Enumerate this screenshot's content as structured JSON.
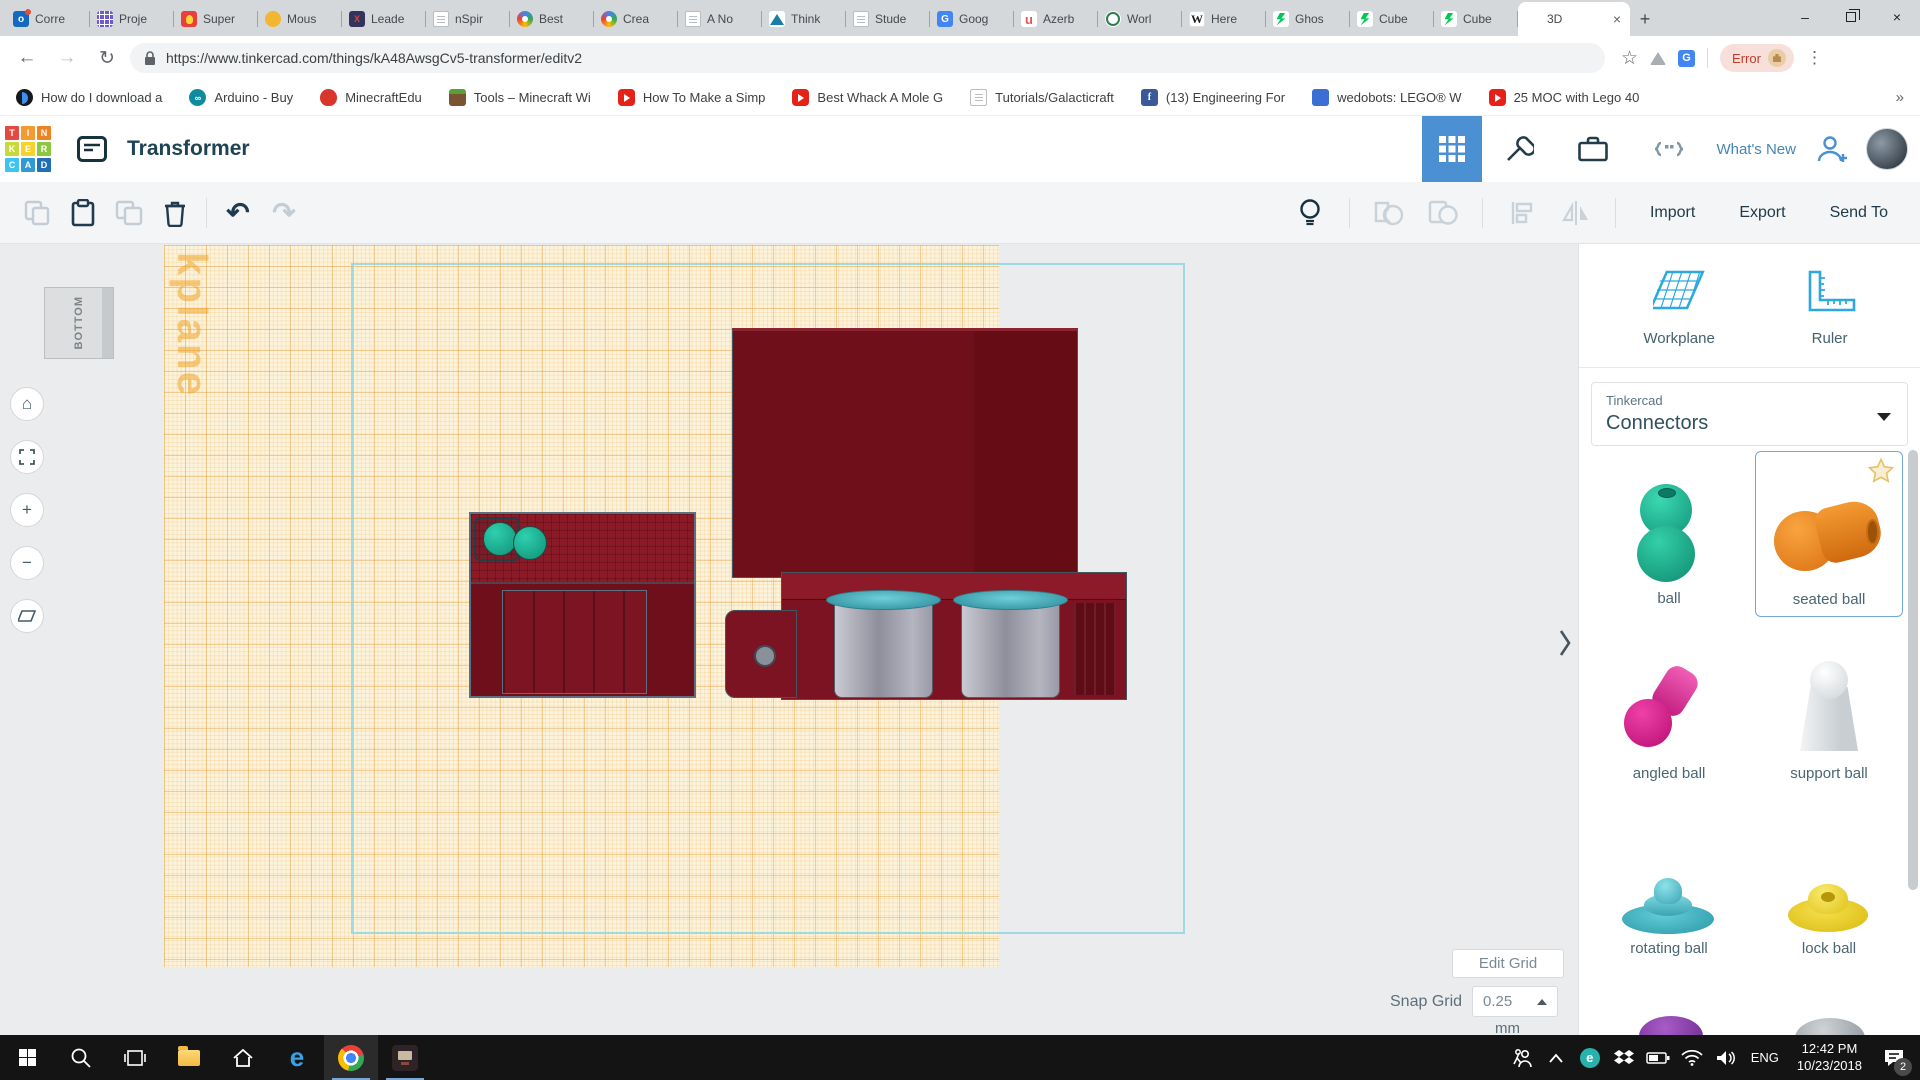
{
  "icons": {
    "back": "←",
    "forward": "→",
    "reload": "↻",
    "star": "☆",
    "menu_dots": "⋮",
    "new_tab": "+",
    "close": "×",
    "overflow": "»",
    "home": "⌂",
    "zoom_in": "+",
    "zoom_out": "−",
    "undo": "↶",
    "redo": "↷",
    "minimize": "–",
    "eset_letter": "e",
    "arduino_glyph": "∞",
    "edx_glyph": "X",
    "udemy_glyph": "u",
    "wiki_glyph": "W",
    "fb_glyph": "f",
    "translate_glyph": "G",
    "outlook_glyph": "o"
  },
  "browser": {
    "tabs": [
      {
        "label": "Corre",
        "icon": "outlook"
      },
      {
        "label": "Proje",
        "icon": "grid-purple"
      },
      {
        "label": "Super",
        "icon": "bulb-red"
      },
      {
        "label": "Mous",
        "icon": "mouse-yellow"
      },
      {
        "label": "Leade",
        "icon": "edx"
      },
      {
        "label": "nSpir",
        "icon": "doc"
      },
      {
        "label": "Best",
        "icon": "palette"
      },
      {
        "label": "Crea",
        "icon": "palette"
      },
      {
        "label": "A No",
        "icon": "doc"
      },
      {
        "label": "Think",
        "icon": "autodesk"
      },
      {
        "label": "Stude",
        "icon": "doc"
      },
      {
        "label": "Goog",
        "icon": "translate"
      },
      {
        "label": "Azerb",
        "icon": "udemy"
      },
      {
        "label": "Worl",
        "icon": "wes"
      },
      {
        "label": "Here",
        "icon": "wikipedia"
      },
      {
        "label": "Ghos",
        "icon": "deviantart"
      },
      {
        "label": "Cube",
        "icon": "deviantart"
      },
      {
        "label": "Cube",
        "icon": "deviantart"
      }
    ],
    "active_tab": {
      "label": "3D",
      "icon": "tinkercad"
    },
    "url": "https://www.tinkercad.com/things/kA48AwsgCv5-transformer/editv2",
    "error_chip": "Error"
  },
  "bookmarks": [
    {
      "label": "How do I download a",
      "icon": "circle-blue"
    },
    {
      "label": "Arduino - Buy",
      "icon": "arduino"
    },
    {
      "label": "MinecraftEdu",
      "icon": "apple-red"
    },
    {
      "label": "Tools – Minecraft Wi",
      "icon": "grass-block"
    },
    {
      "label": "How To Make a Simp",
      "icon": "youtube"
    },
    {
      "label": "Best Whack A Mole G",
      "icon": "youtube"
    },
    {
      "label": "Tutorials/Galacticraft",
      "icon": "doc"
    },
    {
      "label": "(13) Engineering For",
      "icon": "facebook"
    },
    {
      "label": "wedobots: LEGO® W",
      "icon": "robot"
    },
    {
      "label": "25 MOC with Lego 40",
      "icon": "youtube"
    }
  ],
  "header": {
    "title": "Transformer",
    "whats_new": "What's New",
    "logo_letters": [
      "T",
      "I",
      "N",
      "K",
      "E",
      "R",
      "C",
      "A",
      "D"
    ],
    "accent_color": "#4a90d2"
  },
  "toolbar": {
    "import": "Import",
    "export": "Export",
    "send_to": "Send To"
  },
  "canvas": {
    "view_cube": "BOTTOM",
    "watermark": "kplane",
    "edit_grid": "Edit Grid",
    "snap_grid_label": "Snap Grid",
    "snap_grid_value": "0.25",
    "snap_grid_unit": "mm",
    "workplane_color": "#fcf3dc",
    "model_color": "#7c1322"
  },
  "panel": {
    "workplane": "Workplane",
    "ruler": "Ruler",
    "library_brand": "Tinkercad",
    "library_name": "Connectors",
    "shapes": [
      {
        "name": "ball",
        "color": "#21bd9a"
      },
      {
        "name": "seated ball",
        "color": "#f08a24",
        "selected": true
      },
      {
        "name": "angled ball",
        "color": "#df1995"
      },
      {
        "name": "support ball",
        "color": "#dfe3e6"
      },
      {
        "name": "rotating ball",
        "color": "#3bb8c3"
      },
      {
        "name": "lock ball",
        "color": "#f2cf1f"
      }
    ]
  },
  "taskbar": {
    "lang": "ENG",
    "time": "12:42 PM",
    "date": "10/23/2018",
    "badge": "2"
  }
}
